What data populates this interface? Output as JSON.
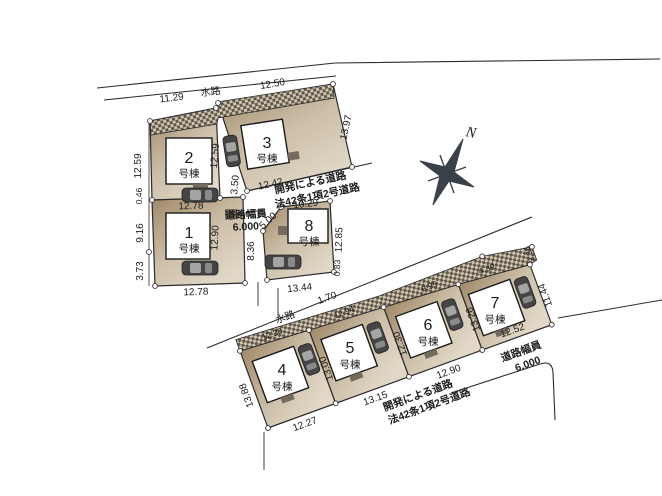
{
  "compass": {
    "north_label": "N"
  },
  "colors": {
    "background": "#ffffff",
    "line": "#2b2b2b",
    "parcel_dark": "#a08868",
    "parcel_light": "#e2d8c8",
    "hatch_dark": "#60584c",
    "hatch_light": "#cfc3ad",
    "building_fill": "#ffffff",
    "car_body": "#454545",
    "car_window": "#a5a5a5",
    "porch": "#746b5e"
  },
  "top_cluster": {
    "waterway": {
      "name": "水路",
      "dim_left": "11.29",
      "dim_right": "12.50"
    },
    "road": {
      "line1": "開発による道路",
      "line2": "法42条1項2号道路"
    },
    "road_width": {
      "label": "道路幅員",
      "value": "6.000"
    },
    "lots": {
      "lot1": {
        "num": "1",
        "suffix": "号棟",
        "dim_top": "12.78",
        "dim_bottom": "12.78",
        "dim_left_upper": "9.16",
        "dim_left_lower": "3.73",
        "dim_left_top": "0.46",
        "dim_right": "12.90"
      },
      "lot2": {
        "num": "2",
        "suffix": "号棟",
        "dim_left": "12.59",
        "dim_right": "12.59"
      },
      "lot3": {
        "num": "3",
        "suffix": "号棟",
        "dim_top": "12.50",
        "dim_right": "13.97",
        "dim_bottom": "12.42",
        "dim_left": "3.50"
      },
      "lot8": {
        "num": "8",
        "suffix": "号棟",
        "dim_top": "10.29",
        "dim_top_left": "5.00",
        "dim_left": "8.36",
        "dim_right": "12.85",
        "dim_bottom": "13.44",
        "dim_bottom_right": "0.83"
      }
    }
  },
  "bottom_cluster": {
    "waterway": {
      "name": "水路",
      "dim": "1.70"
    },
    "road": {
      "line1": "開発による道路",
      "line2": "法42条1項2号道路"
    },
    "road_width": {
      "label": "道路幅員",
      "value": "6.000"
    },
    "lots": {
      "lot4": {
        "num": "4",
        "suffix": "号棟",
        "dim_left": "13.88",
        "dim_bottom": "12.27",
        "dim_top": "12.30"
      },
      "lot5": {
        "num": "5",
        "suffix": "号棟",
        "dim_left": "13.00",
        "dim_bottom": "13.15",
        "dim_top": "12.94"
      },
      "lot6": {
        "num": "6",
        "suffix": "号棟",
        "dim_left": "12.30",
        "dim_bottom": "12.90",
        "dim_top": "9.95"
      },
      "lot7": {
        "num": "7",
        "suffix": "号棟",
        "dim_left": "13.26",
        "dim_bottom": "12.52",
        "dim_right": "11.44",
        "dim_top": "4.39",
        "dim_top_right": "2.36"
      }
    }
  }
}
